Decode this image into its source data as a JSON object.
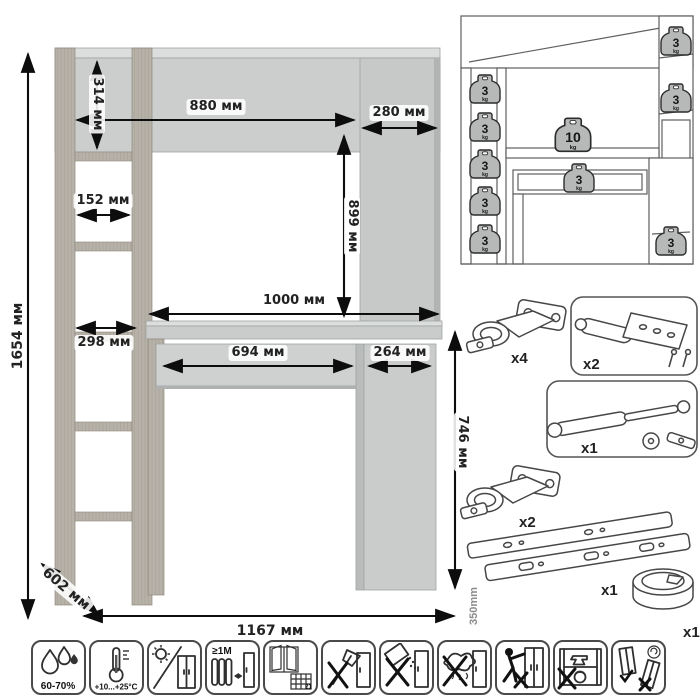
{
  "main_diagram": {
    "labels": {
      "total_height": "1654 мм",
      "hutch_height": "314 мм",
      "hutch_width": "880 мм",
      "top_cabinet_width": "280 мм",
      "top_cabinet_height": "899 мм",
      "shelf_opening": "152 мм",
      "shelf_depth": "298 мм",
      "desktop_width": "1000 мм",
      "drawer_width": "694 мм",
      "base_cabinet_width": "264 мм",
      "desk_height": "746 мм",
      "depth": "602 мм",
      "total_width": "1167 мм"
    }
  },
  "load_diagram": {
    "badges": [
      {
        "value": "3",
        "unit": "kg",
        "position": "left-shelf-1"
      },
      {
        "value": "3",
        "unit": "kg",
        "position": "left-shelf-2"
      },
      {
        "value": "3",
        "unit": "kg",
        "position": "left-shelf-3"
      },
      {
        "value": "3",
        "unit": "kg",
        "position": "left-shelf-4"
      },
      {
        "value": "3",
        "unit": "kg",
        "position": "left-shelf-5"
      },
      {
        "value": "3",
        "unit": "kg",
        "position": "right-top-shelf"
      },
      {
        "value": "3",
        "unit": "kg",
        "position": "right-shelf"
      },
      {
        "value": "10",
        "unit": "kg",
        "position": "desktop"
      },
      {
        "value": "3",
        "unit": "kg",
        "position": "drawer"
      },
      {
        "value": "3",
        "unit": "kg",
        "position": "base-cabinet"
      }
    ]
  },
  "hardware": {
    "items": [
      {
        "name": "hinge",
        "qty": "x4"
      },
      {
        "name": "door-damper-with-screws",
        "qty": "x2"
      },
      {
        "name": "gas-lift",
        "qty": "x1"
      },
      {
        "name": "hinge",
        "qty": "x2"
      },
      {
        "name": "drawer-slides",
        "qty": "x1",
        "length_label": "350mm"
      },
      {
        "name": "cable-grommet",
        "qty": "x1"
      }
    ]
  },
  "care_icons": [
    {
      "name": "humidity",
      "label": "60-70%"
    },
    {
      "name": "temperature",
      "label": "+10...+25°С"
    },
    {
      "name": "no-direct-sunlight",
      "label": ""
    },
    {
      "name": "distance-from-heaters",
      "label": "≥1М"
    },
    {
      "name": "ventilation-calendar",
      "label": "21"
    },
    {
      "name": "no-sharp-tools",
      "label": ""
    },
    {
      "name": "no-abrasive-cleaners",
      "label": ""
    },
    {
      "name": "no-wet-cleaning",
      "label": ""
    },
    {
      "name": "no-dragging",
      "label": ""
    },
    {
      "name": "no-overloading",
      "label": ""
    },
    {
      "name": "no-tilting",
      "label": ""
    }
  ]
}
